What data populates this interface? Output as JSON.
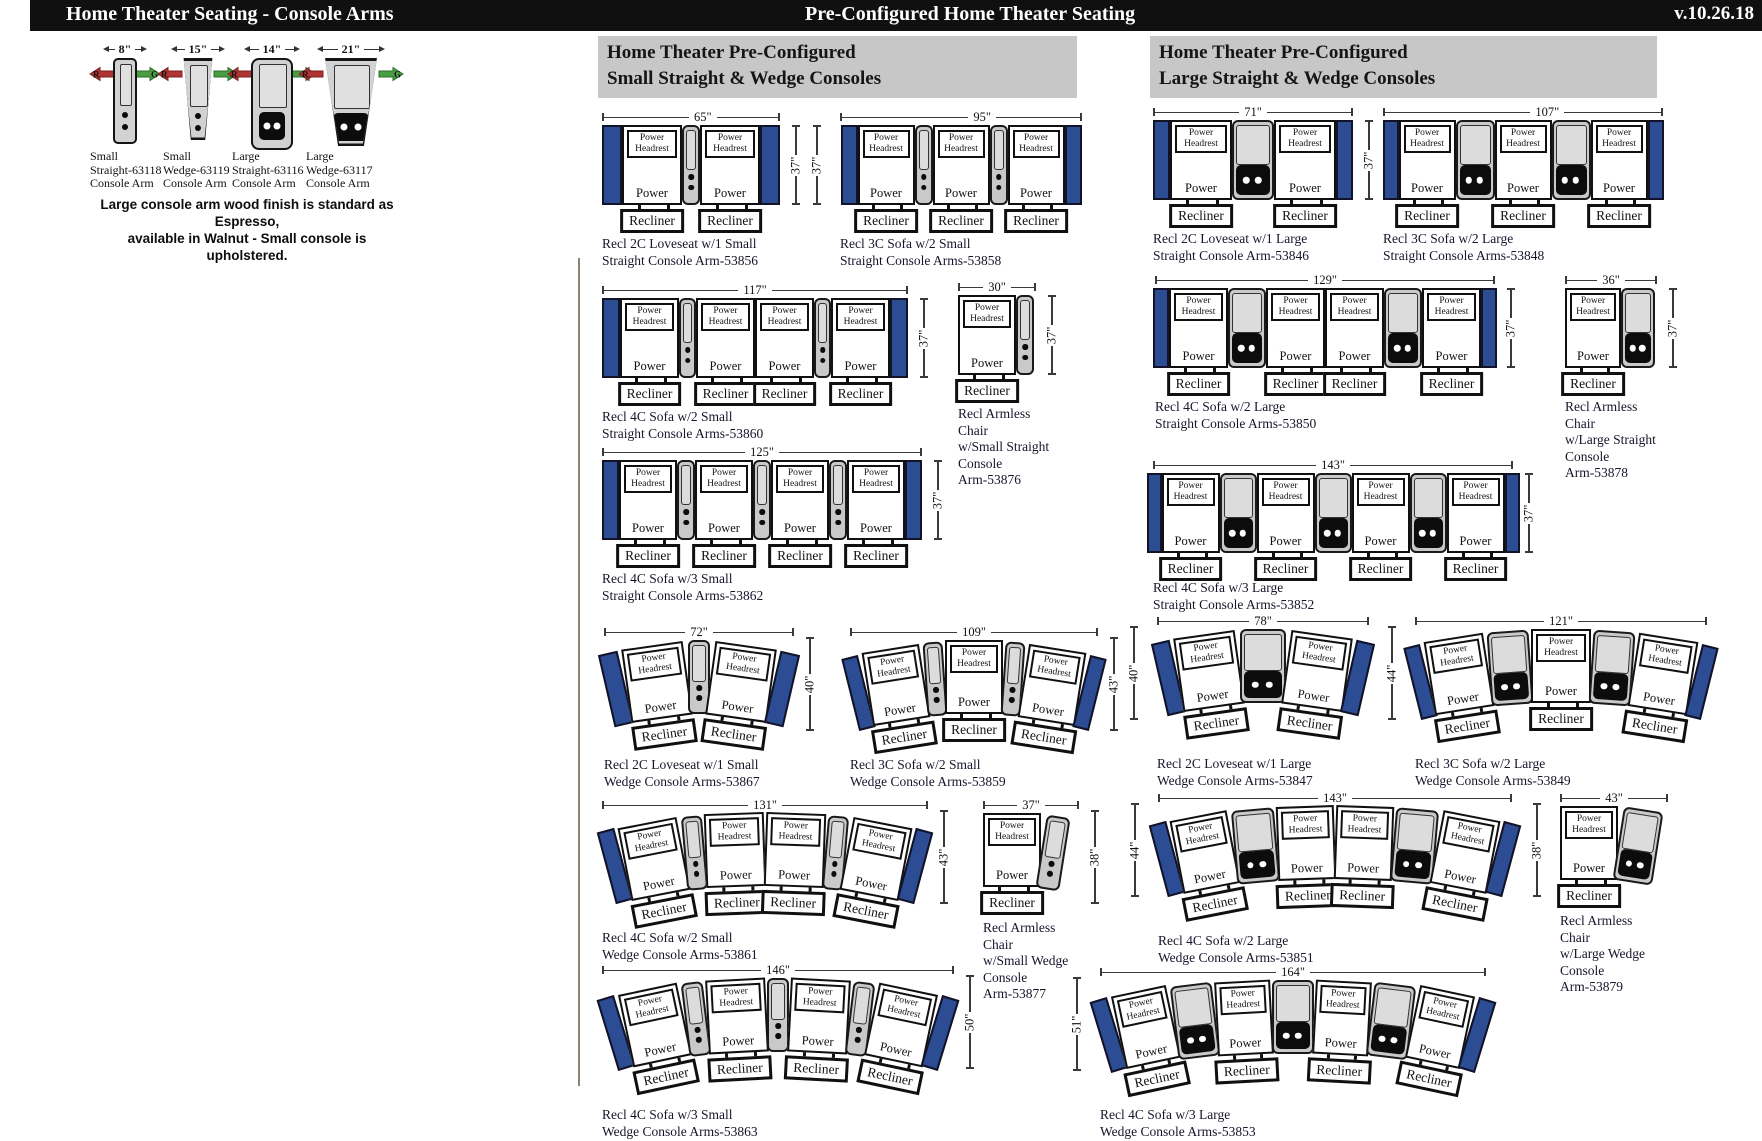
{
  "header": {
    "left_title": "Home Theater Seating - Console Arms",
    "center_title": "Pre-Configured Home Theater Seating",
    "version": "v.10.26.18"
  },
  "colors": {
    "bar_black": "#101010",
    "header_gray": "#c7c7c7",
    "arm_navy": "#2c4c94",
    "console_gray": "#c9c9c9",
    "divider": "#8b8174"
  },
  "labels": {
    "power_headrest_lines": [
      "Power",
      "Headrest"
    ],
    "power": "Power",
    "recliner": "Recliner"
  },
  "console_arms": {
    "items": [
      {
        "width_label": "8\"",
        "type": "small-straight",
        "label_lines": [
          "Small",
          "Straight-63118",
          "Console Arm"
        ]
      },
      {
        "width_label": "15\"",
        "type": "small-wedge",
        "label_lines": [
          "Small",
          "Wedge-63119",
          "Console Arm"
        ]
      },
      {
        "width_label": "14\"",
        "type": "large-straight",
        "label_lines": [
          "Large",
          "Straight-63116",
          "Console Arm"
        ]
      },
      {
        "width_label": "21\"",
        "type": "large-wedge",
        "label_lines": [
          "Large",
          "Wedge-63117",
          "Console Arm"
        ]
      }
    ],
    "red_arrow_letter": "R",
    "green_arrow_letter": "G",
    "note_lines": [
      "Large console arm wood finish is standard as Espresso,",
      "available in Walnut - Small console is upholstered."
    ]
  },
  "sections": [
    {
      "title_lines": [
        "Home Theater Pre-Configured",
        "Small Straight & Wedge Consoles"
      ],
      "x": 598,
      "y": 36,
      "w": 470,
      "h": 58
    },
    {
      "title_lines": [
        "Home Theater Pre-Configured",
        "Large Straight & Wedge Consoles"
      ],
      "x": 1150,
      "y": 36,
      "w": 498,
      "h": 58
    }
  ],
  "diagrams": [
    {
      "id": "53856",
      "x": 602,
      "y": 112,
      "w": 178,
      "width_label": "65\"",
      "height_label": "37\"",
      "height_side": "right",
      "lp": 0.58,
      "console": "small",
      "structure": [
        "arm",
        "seat",
        "console",
        "seat",
        "arm"
      ],
      "sizes": {
        "arm": 20,
        "seat": 60,
        "console": 18,
        "seatH": 80
      },
      "cap_top": 124,
      "caption_lines": [
        "Recl 2C Loveseat w/1 Small",
        "Straight Console Arm-53856"
      ]
    },
    {
      "id": "53858",
      "x": 840,
      "y": 112,
      "w": 242,
      "width_label": "95\"",
      "height_label": "37\"",
      "height_side": "left",
      "lp": 0.6,
      "console": "small",
      "structure": [
        "arm",
        "seat",
        "console",
        "seat",
        "console",
        "seat",
        "arm"
      ],
      "sizes": {
        "arm": 17,
        "seat": 57,
        "console": 18,
        "seatH": 80
      },
      "cap_top": 124,
      "caption_lines": [
        "Recl 3C Sofa w/2 Small",
        "Straight Console Arms-53858"
      ]
    },
    {
      "id": "53860",
      "x": 602,
      "y": 285,
      "w": 306,
      "width_label": "117\"",
      "height_label": "37\"",
      "height_side": "right",
      "console": "small",
      "structure": [
        "arm",
        "seat",
        "console",
        "seat",
        "seat",
        "console",
        "seat",
        "arm"
      ],
      "sizes": {
        "arm": 18,
        "seat": 59,
        "console": 17,
        "seatH": 80
      },
      "cap_top": 124,
      "caption_lines": [
        "Recl 4C Sofa w/2 Small",
        "Straight Console Arms-53860"
      ]
    },
    {
      "id": "53876",
      "x": 958,
      "y": 282,
      "w": 78,
      "width_label": "30\"",
      "height_label": "37\"",
      "height_side": "right",
      "console": "small",
      "structure": [
        "seat",
        "console"
      ],
      "sizes": {
        "arm": 0,
        "seat": 58,
        "console": 18,
        "seatH": 80
      },
      "cap_top": 124,
      "caption_lines": [
        "Recl Armless",
        "Chair",
        "w/Small Straight",
        "Console",
        "Arm-53876"
      ]
    },
    {
      "id": "53862",
      "x": 602,
      "y": 447,
      "w": 320,
      "width_label": "125\"",
      "height_label": "37\"",
      "height_side": "right",
      "console": "small",
      "structure": [
        "arm",
        "seat",
        "console",
        "seat",
        "console",
        "seat",
        "console",
        "seat",
        "arm"
      ],
      "sizes": {
        "arm": 17,
        "seat": 58,
        "console": 18,
        "seatH": 80
      },
      "cap_top": 124,
      "caption_lines": [
        "Recl 4C Sofa w/3 Small",
        "Straight Console Arms-53862"
      ]
    },
    {
      "id": "53867",
      "x": 604,
      "y": 627,
      "w": 190,
      "width_label": "72\"",
      "height_label": "40\"",
      "height_side": "right",
      "console": "small",
      "structure": [
        "arm",
        "seat",
        "console",
        "seat",
        "arm"
      ],
      "sizes": {
        "arm": 20,
        "seat": 62,
        "console": 22,
        "seatH": 74
      },
      "angles": [
        -13,
        -8,
        0,
        8,
        13
      ],
      "lifts": [
        12,
        5,
        0,
        5,
        12
      ],
      "cap_top": 130,
      "caption_lines": [
        "Recl 2C Loveseat w/1 Small",
        "Wedge Console Arms-53867"
      ]
    },
    {
      "id": "53859",
      "x": 850,
      "y": 627,
      "w": 248,
      "width_label": "109\"",
      "height_label": "43\"",
      "height_side": "right",
      "console": "small",
      "structure": [
        "arm",
        "seat",
        "console",
        "seat",
        "console",
        "seat",
        "arm"
      ],
      "sizes": {
        "arm": 17,
        "seat": 58,
        "console": 20,
        "seatH": 74
      },
      "angles": [
        -14,
        -9,
        -4,
        0,
        4,
        9,
        14
      ],
      "lifts": [
        16,
        8,
        2,
        0,
        2,
        8,
        16
      ],
      "cap_top": 130,
      "caption_lines": [
        "Recl 3C Sofa w/2 Small",
        "Wedge Console Arms-53859"
      ]
    },
    {
      "id": "53861",
      "x": 602,
      "y": 800,
      "w": 326,
      "width_label": "131\"",
      "height_label": "43\"",
      "height_side": "right",
      "console": "small",
      "structure": [
        "arm",
        "seat",
        "console",
        "seat",
        "seat",
        "console",
        "seat",
        "arm"
      ],
      "sizes": {
        "arm": 18,
        "seat": 60,
        "console": 21,
        "seatH": 74
      },
      "angles": [
        -15,
        -11,
        -5,
        -2,
        2,
        5,
        11,
        15
      ],
      "lifts": [
        16,
        9,
        3,
        0,
        0,
        3,
        9,
        16
      ],
      "cap_top": 130,
      "caption_lines": [
        "Recl 4C Sofa w/2 Small",
        "Wedge Console Arms-53861"
      ]
    },
    {
      "id": "53877",
      "x": 983,
      "y": 800,
      "w": 96,
      "width_label": "37\"",
      "height_label": "38\"",
      "height_side": "right",
      "console": "small",
      "structure": [
        "seat",
        "console"
      ],
      "sizes": {
        "arm": 0,
        "seat": 58,
        "console": 24,
        "seatH": 74
      },
      "angles": [
        0,
        9
      ],
      "lifts": [
        0,
        3
      ],
      "cap_top": 120,
      "caption_lines": [
        "Recl Armless",
        "Chair",
        "w/Small Wedge",
        "Console",
        "Arm-53877"
      ]
    },
    {
      "id": "53863",
      "x": 602,
      "y": 965,
      "w": 352,
      "width_label": "146\"",
      "height_label": "50\"",
      "height_side": "right",
      "console": "small",
      "structure": [
        "arm",
        "seat",
        "console",
        "seat",
        "console",
        "seat",
        "console",
        "seat",
        "arm"
      ],
      "sizes": {
        "arm": 18,
        "seat": 60,
        "console": 22,
        "seatH": 74
      },
      "angles": [
        -17,
        -12,
        -7,
        -3,
        0,
        3,
        7,
        12,
        17
      ],
      "lifts": [
        18,
        10,
        4,
        1,
        0,
        1,
        4,
        10,
        18
      ],
      "cap_top": 142,
      "caption_lines": [
        "Recl 4C Sofa w/3 Small",
        "Wedge Console Arms-53863"
      ]
    },
    {
      "id": "53846",
      "x": 1153,
      "y": 107,
      "w": 200,
      "width_label": "71\"",
      "height_label": "37\"",
      "height_side": "right",
      "console": "large",
      "structure": [
        "arm",
        "seat",
        "console",
        "seat",
        "arm"
      ],
      "sizes": {
        "arm": 17,
        "seat": 62,
        "console": 42,
        "seatH": 80
      },
      "cap_top": 124,
      "caption_lines": [
        "Recl 2C Loveseat w/1 Large",
        "Straight Console Arm-53846"
      ]
    },
    {
      "id": "53848",
      "x": 1383,
      "y": 107,
      "w": 280,
      "width_label": "107\"",
      "height_label": "37\"",
      "height_side": "none",
      "lp": 0.6,
      "console": "large",
      "structure": [
        "arm",
        "seat",
        "console",
        "seat",
        "console",
        "seat",
        "arm"
      ],
      "sizes": {
        "arm": 16,
        "seat": 57,
        "console": 39,
        "seatH": 80
      },
      "cap_top": 124,
      "caption_lines": [
        "Recl 3C Sofa w/2 Large",
        "Straight Console Arms-53848"
      ]
    },
    {
      "id": "53850",
      "x": 1155,
      "y": 275,
      "w": 340,
      "width_label": "129\"",
      "height_label": "37\"",
      "height_side": "right",
      "console": "large",
      "structure": [
        "arm",
        "seat",
        "console",
        "seat",
        "seat",
        "console",
        "seat",
        "arm"
      ],
      "sizes": {
        "arm": 16,
        "seat": 59,
        "console": 38,
        "seatH": 80
      },
      "cap_top": 124,
      "caption_lines": [
        "Recl 4C Sofa w/2 Large",
        "Straight Console Arms-53850"
      ]
    },
    {
      "id": "53878",
      "x": 1565,
      "y": 275,
      "w": 92,
      "width_label": "36\"",
      "height_label": "37\"",
      "height_side": "right",
      "console": "large",
      "structure": [
        "seat",
        "console"
      ],
      "sizes": {
        "arm": 0,
        "seat": 56,
        "console": 34,
        "seatH": 80
      },
      "cap_top": 124,
      "caption_lines": [
        "Recl Armless",
        "Chair",
        "w/Large Straight",
        "Console",
        "Arm-53878"
      ]
    },
    {
      "id": "53852",
      "x": 1153,
      "y": 460,
      "w": 360,
      "width_label": "143\"",
      "height_label": "37\"",
      "height_side": "right",
      "console": "large",
      "structure": [
        "arm",
        "seat",
        "console",
        "seat",
        "console",
        "seat",
        "console",
        "seat",
        "arm"
      ],
      "sizes": {
        "arm": 15,
        "seat": 58,
        "console": 37,
        "seatH": 80
      },
      "cap_top": 120,
      "caption_lines": [
        "Recl 4C Sofa w/3 Large",
        "Straight Console Arms-53852"
      ]
    },
    {
      "id": "53847",
      "x": 1157,
      "y": 616,
      "w": 212,
      "width_label": "78\"",
      "height_label": "40\"",
      "height_side": "left",
      "console": "large",
      "structure": [
        "arm",
        "seat",
        "console",
        "seat",
        "arm"
      ],
      "sizes": {
        "arm": 19,
        "seat": 62,
        "console": 46,
        "seatH": 74
      },
      "angles": [
        -13,
        -8,
        0,
        8,
        13
      ],
      "lifts": [
        12,
        5,
        0,
        5,
        12
      ],
      "cap_top": 140,
      "caption_lines": [
        "Recl 2C Loveseat w/1 Large",
        "Wedge Console Arms-53847"
      ]
    },
    {
      "id": "53849",
      "x": 1415,
      "y": 616,
      "w": 292,
      "width_label": "121\"",
      "height_label": "44\"",
      "height_side": "left",
      "console": "large",
      "structure": [
        "arm",
        "seat",
        "console",
        "seat",
        "console",
        "seat",
        "arm"
      ],
      "sizes": {
        "arm": 17,
        "seat": 60,
        "console": 42,
        "seatH": 74
      },
      "angles": [
        -14,
        -9,
        -4,
        0,
        4,
        9,
        14
      ],
      "lifts": [
        16,
        8,
        2,
        0,
        2,
        8,
        16
      ],
      "cap_top": 140,
      "caption_lines": [
        "Recl 3C Sofa w/2 Large",
        "Wedge Console Arms-53849"
      ]
    },
    {
      "id": "53851",
      "x": 1158,
      "y": 793,
      "w": 354,
      "width_label": "143\"",
      "height_label": "44\"",
      "height_side": "left",
      "console": "large",
      "structure": [
        "arm",
        "seat",
        "console",
        "seat",
        "seat",
        "console",
        "seat",
        "arm"
      ],
      "sizes": {
        "arm": 18,
        "seat": 58,
        "console": 43,
        "seatH": 74
      },
      "angles": [
        -15,
        -11,
        -5,
        -2,
        2,
        5,
        11,
        15
      ],
      "lifts": [
        16,
        9,
        3,
        0,
        0,
        3,
        9,
        16
      ],
      "cap_top": 140,
      "caption_lines": [
        "Recl 4C Sofa w/2 Large",
        "Wedge Console Arms-53851"
      ]
    },
    {
      "id": "53879",
      "x": 1560,
      "y": 793,
      "w": 108,
      "width_label": "43\"",
      "height_label": "38\"",
      "height_side": "left",
      "console": "large",
      "structure": [
        "seat",
        "console"
      ],
      "sizes": {
        "arm": 0,
        "seat": 58,
        "console": 40,
        "seatH": 74
      },
      "angles": [
        0,
        9
      ],
      "lifts": [
        0,
        3
      ],
      "cap_top": 120,
      "caption_lines": [
        "Recl Armless",
        "Chair",
        "w/Large Wedge",
        "Console",
        "Arm-53879"
      ]
    },
    {
      "id": "53853",
      "x": 1100,
      "y": 967,
      "w": 386,
      "width_label": "164\"",
      "height_label": "51\"",
      "height_side": "left",
      "console": "large",
      "structure": [
        "arm",
        "seat",
        "console",
        "seat",
        "console",
        "seat",
        "console",
        "seat",
        "arm"
      ],
      "sizes": {
        "arm": 18,
        "seat": 56,
        "console": 42,
        "seatH": 74
      },
      "angles": [
        -17,
        -12,
        -7,
        -3,
        0,
        3,
        7,
        12,
        17
      ],
      "lifts": [
        18,
        10,
        4,
        1,
        0,
        1,
        4,
        10,
        18
      ],
      "cap_top": 140,
      "caption_lines": [
        "Recl 4C Sofa w/3 Large",
        "Wedge Console Arms-53853"
      ]
    }
  ],
  "divider": {
    "x": 578,
    "y": 258,
    "h": 828
  }
}
